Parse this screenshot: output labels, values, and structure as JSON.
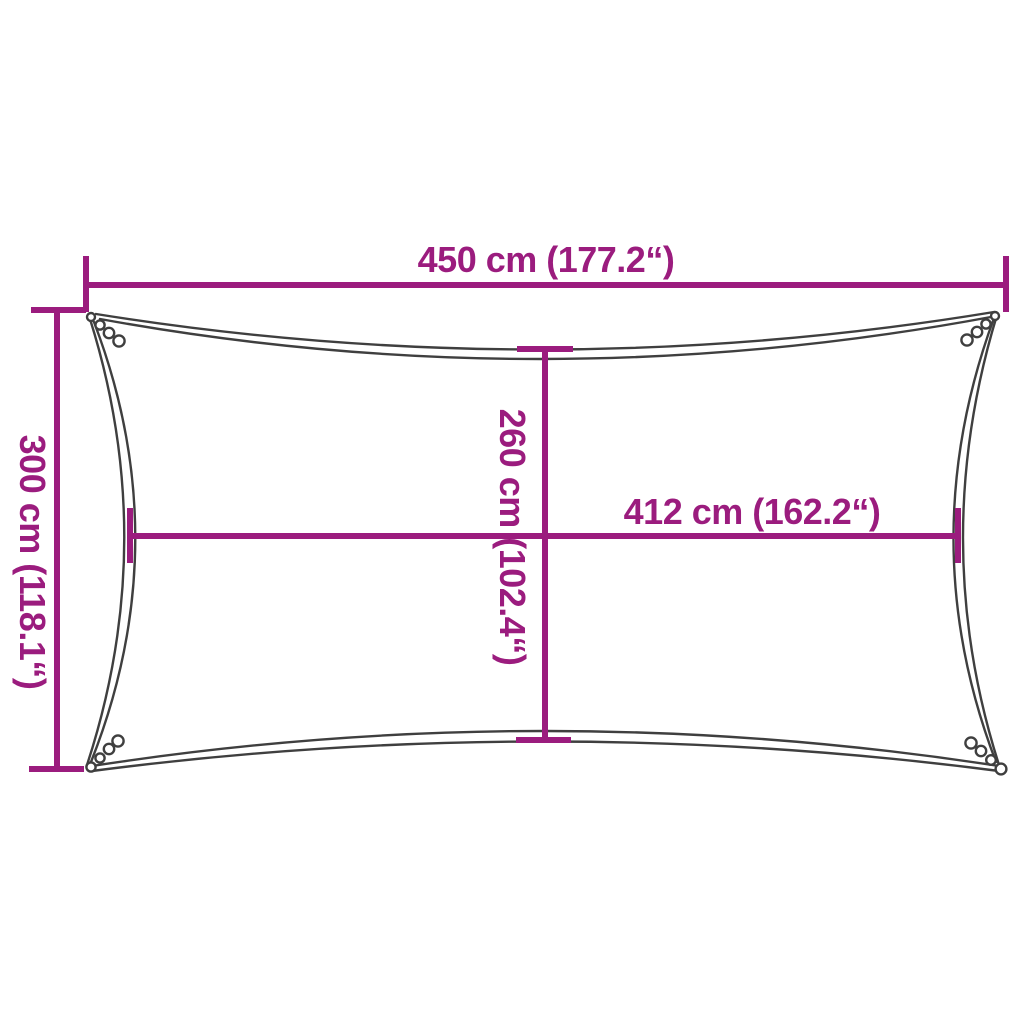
{
  "colors": {
    "dimension_line": "#9b1c7e",
    "sail_outline": "#3f3f3f",
    "background": "#ffffff"
  },
  "labels": {
    "top_width": "450 cm (177.2“)",
    "side_height": "300 cm (118.1“)",
    "center_height": "260 cm (102.4“)",
    "center_width": "412 cm (162.2“)"
  },
  "measurements": {
    "top_width_cm": "450",
    "top_width_in": "177.2",
    "side_height_cm": "300",
    "side_height_in": "118.1",
    "center_height_cm": "260",
    "center_height_in": "102.4",
    "center_width_cm": "412",
    "center_width_in": "162.2",
    "unit_metric": "cm"
  }
}
